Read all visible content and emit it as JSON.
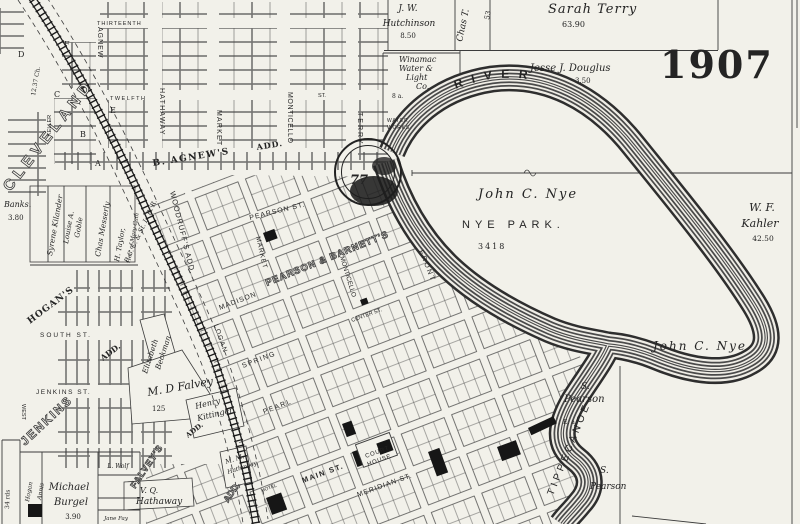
{
  "year": "1907",
  "river": {
    "upper": "RIVER",
    "lower": "TIPPECANOE"
  },
  "park": {
    "owner": "John C. Nye",
    "name": "NYE PARK.",
    "number": "3418"
  },
  "parcels": {
    "sarah": "Sarah Terry",
    "sarah_acres": "63.90",
    "jw_line1": "J. W.",
    "jw_line2": "Hutchinson",
    "jw_acres": "8.50",
    "chas": "Chas T.",
    "chas_acres": "53",
    "jesse": "Jesse J. Douglus",
    "jesse_acres": "3.50",
    "kahler_line1": "W. F.",
    "kahler_line2": "Kahler",
    "kahler_acres": "42.50",
    "nye_south": "John C. Nye",
    "pearson_w_initial": "S.",
    "pearson_w": "Pearson",
    "pearson_w_note": "E. a.",
    "pearson_e_initial": "S.",
    "pearson_e": "Pearson",
    "burgel_line1": "Michael",
    "burgel_line2": "Burgel",
    "burgel_acres": "3.90",
    "wolf": "L. Wolf",
    "fay": "Jane Fay",
    "falvey": "M. D Falvey",
    "falvey_acres": "125",
    "kittinger_line1": "Henry",
    "kittinger_line2": "Kittinger",
    "beckman_line1": "Elizabeth",
    "beckman_line2": "Beckman",
    "vq_line1": "V. Q.",
    "vq_line2": "Hathaway",
    "mm_line1": "M. M.",
    "mm_line2": "Hathaway",
    "kilander": "Syrene Kilander",
    "goble_line1": "Louise A.",
    "goble_line2": "Goble",
    "messerly": "Chas Messerly",
    "taylor_line1": "H. Taylor,",
    "taylor_line2": "Heir of Mary Cain",
    "banks": "Banks.",
    "banks_acres": "3.80",
    "hogan_small": "Hogan",
    "annis_small": "Annis",
    "rods": "34 rds",
    "water_line1": "Winamac",
    "water_line2": "Water &",
    "water_line3": "Light",
    "water_line4": "Co.",
    "water_acres": "8 a."
  },
  "streets": {
    "thirteenth": "THIRTEENTH",
    "twelfth": "TWELFTH",
    "st_small": "ST.",
    "agnew": "AGNEW",
    "hathaway": "HATHAWAY",
    "market_n": "MARKET",
    "monticello_n": "MONTICELLO",
    "terry": "TERRY",
    "south": "SOUTH  ST.",
    "jenkins": "JENKINS  ST.",
    "west": "WEST",
    "pearson": "PEARSON ST.",
    "madison": "MADISON",
    "spring": "SPRING",
    "pearl": "PEARL",
    "main": "MAIN ST.",
    "meridian": "MERIDIAN ST.",
    "center": "CENTER ST.",
    "front": "FRONT",
    "market_s": "MARKET",
    "monticello_s": "MONTICELLO",
    "logan": "LOGAN"
  },
  "railroad": {
    "name": "P. C. C. & St. L. R. R.",
    "big_label": "CLEVELAND"
  },
  "additions": {
    "agnew": "B. AGNEW'S",
    "agnew_add": "ADD.",
    "woodruff": "WOODRUFF'S ADD.",
    "pearson_barnett": "PEARSON & BARNETT'S",
    "hogan": "HOGAN'S",
    "hogan_add": "ADD.",
    "jenkins": "JENKINS",
    "falvey": "FALVEY'S",
    "falvey_add": "ADD.",
    "add_small": "ADD."
  },
  "landmarks": {
    "court_line1": "COURT",
    "court_line2": "HOUSE",
    "hotel": "HOTEL",
    "water_works_line1": "WATER",
    "water_works_line2": "WORKS",
    "seal_number": "77",
    "keller": "KELLER",
    "chain": "12.37 Ch."
  },
  "blocks": {
    "a": "A",
    "b": "B",
    "c": "C",
    "d": "D",
    "e": "E",
    "f": "F"
  }
}
